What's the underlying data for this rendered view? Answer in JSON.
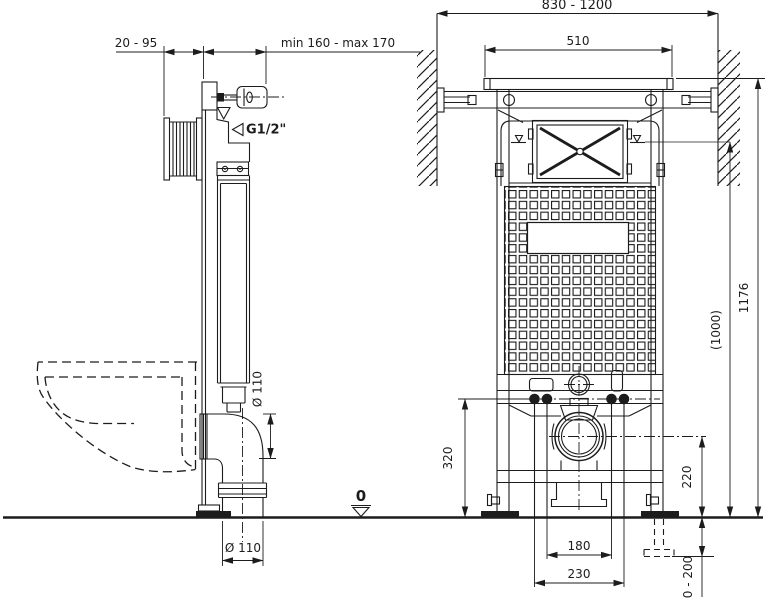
{
  "side_view": {
    "wall_offset_range": "20 - 95",
    "installation_depth_range": "min 160 - max 170",
    "water_supply_thread": "G1/2\"",
    "outlet_elbow_diameter": "Ø 110",
    "outlet_pipe_diameter": "Ø 110",
    "floor_level_mark": "0"
  },
  "front_view": {
    "wall_to_wall_span": "830 - 1200",
    "frame_width": "510",
    "frame_height": "1176",
    "water_level_height": "(1000)",
    "fixing_rail_height": "320",
    "outlet_center_height": "220",
    "bolt_spacing_narrow": "180",
    "bolt_spacing_wide": "230",
    "leg_adjustment_range": "0 - 200"
  },
  "colors": {
    "line": "#1c1c1c",
    "background": "#ffffff"
  }
}
